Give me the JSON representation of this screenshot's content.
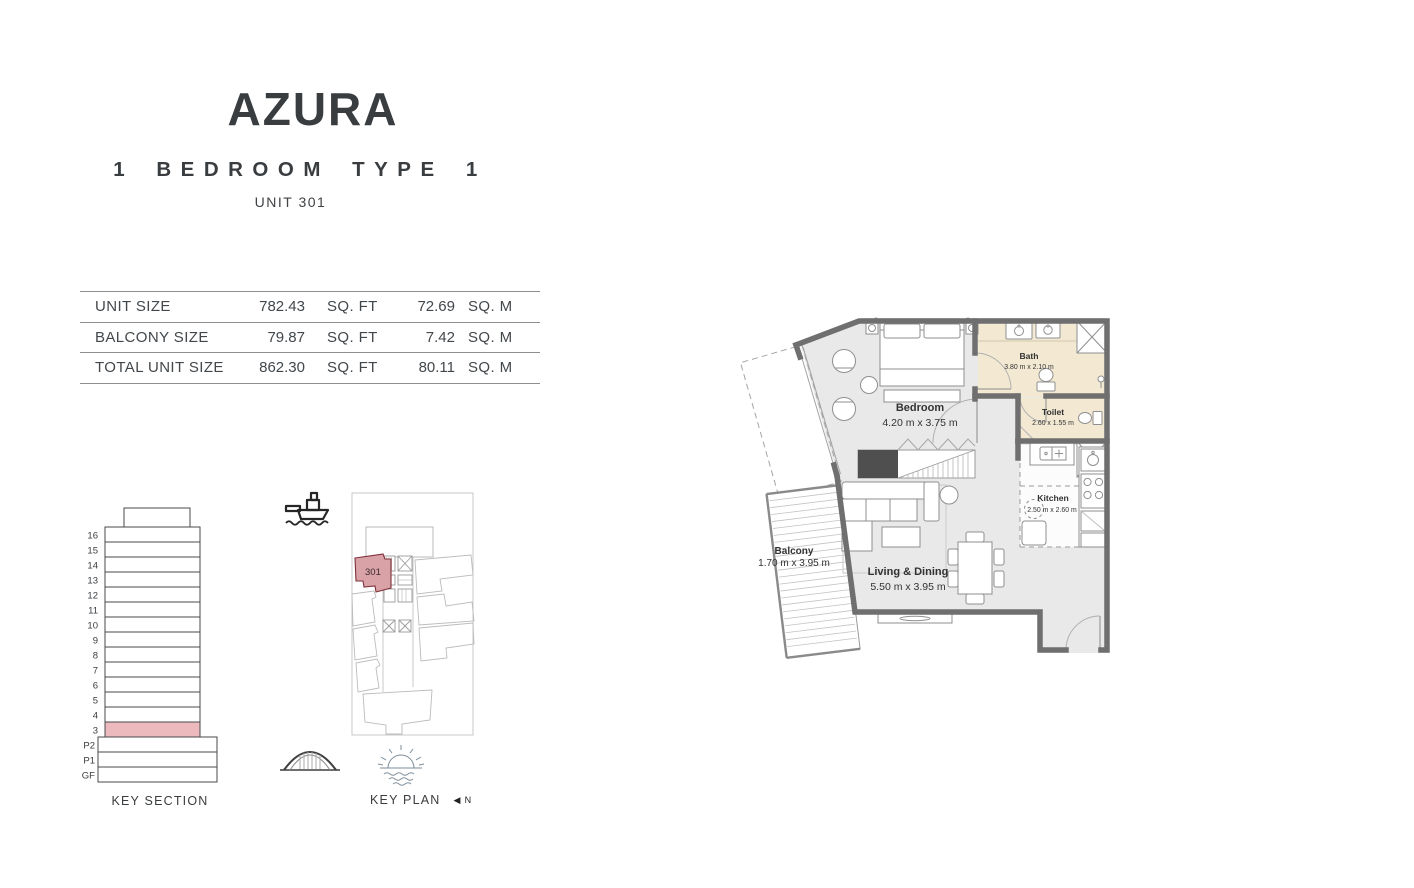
{
  "header": {
    "title": "AZURA",
    "subtitle": "1 BEDROOM TYPE 1",
    "unit_label": "UNIT 301"
  },
  "size_table": {
    "rows": [
      {
        "label": "UNIT SIZE",
        "sqft_value": "782.43",
        "sqft_unit": "SQ. FT",
        "sqm_value": "72.69",
        "sqm_unit": "SQ. M"
      },
      {
        "label": "BALCONY SIZE",
        "sqft_value": "79.87",
        "sqft_unit": "SQ. FT",
        "sqm_value": "7.42",
        "sqm_unit": "SQ. M"
      },
      {
        "label": "TOTAL UNIT SIZE",
        "sqft_value": "862.30",
        "sqft_unit": "SQ. FT",
        "sqm_value": "80.11",
        "sqm_unit": "SQ. M"
      }
    ]
  },
  "key_section": {
    "caption": "KEY SECTION",
    "floors": [
      "16",
      "15",
      "14",
      "13",
      "12",
      "11",
      "10",
      "9",
      "8",
      "7",
      "6",
      "5",
      "4",
      "3",
      "P2",
      "P1",
      "GF"
    ],
    "highlighted_floor": "3",
    "highlight_color": "#ecb9bd"
  },
  "key_plan": {
    "caption": "KEY PLAN",
    "north_label": "N",
    "unit_number": "301",
    "unit_fill": "#d9a2a7"
  },
  "floor_plan": {
    "rooms": {
      "bedroom": {
        "name": "Bedroom",
        "dims": "4.20 m x 3.75 m"
      },
      "bath": {
        "name": "Bath",
        "dims": "3.80 m x 2.10 m"
      },
      "toilet": {
        "name": "Toilet",
        "dims": "2.60 x 1.55 m"
      },
      "kitchen": {
        "name": "Kitchen",
        "dims": "2.50 m x 2.60 m"
      },
      "living": {
        "name": "Living & Dining",
        "dims": "5.50 m x 3.95 m"
      },
      "balcony": {
        "name": "Balcony",
        "dims": "1.70 m x 3.95 m"
      }
    },
    "colors": {
      "floor": "#e9e9e9",
      "wet_area": "#f3e9d3",
      "wall": "#6f6f6f",
      "accent": "#4f4f4f"
    }
  }
}
